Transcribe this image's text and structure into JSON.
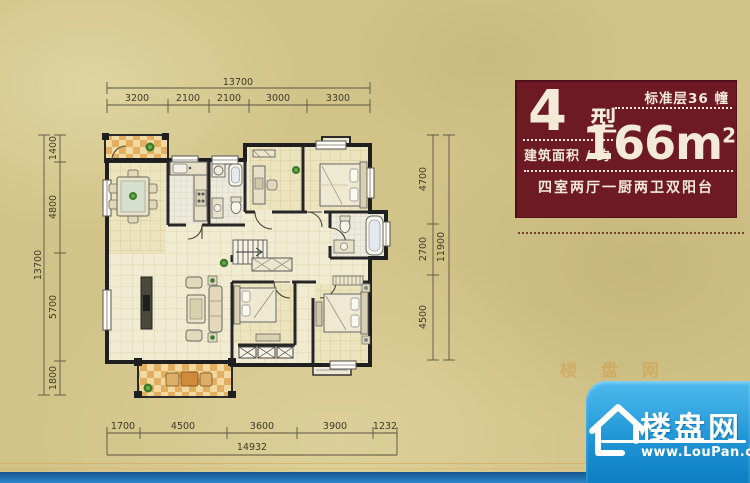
{
  "info_panel": {
    "type_number": "4",
    "type_suffix": "型",
    "floors_label": "标准层36 幢",
    "area_label": "建筑面积 / 约",
    "area_value": "166m",
    "area_exponent": "2",
    "description": "四室两厅一厨两卫双阳台",
    "bg_color": "#6d1a24"
  },
  "dimensions": {
    "top": {
      "total": "13700",
      "segments": [
        "3200",
        "2100",
        "2100",
        "3000",
        "3300"
      ]
    },
    "left": {
      "total": "13700",
      "segments": [
        "1400",
        "4800",
        "5700",
        "1800"
      ]
    },
    "right": {
      "total": "11900",
      "segments": [
        "4700",
        "2700",
        "4500"
      ]
    },
    "bottom": {
      "total": "14932",
      "segments": [
        "1700",
        "4500",
        "3600",
        "3900",
        "1232"
      ]
    }
  },
  "watermark": {
    "faint_text": "楼盘网",
    "brand": "楼盘网",
    "url": "www.LouPan.com",
    "badge_blue_top": "#4fbbee",
    "badge_blue_bottom": "#0d7ec3",
    "bar_blue": "#2478ba"
  },
  "plan_colors": {
    "wall": "#1f1f1f",
    "balcony_tile_light": "#f3d99f",
    "balcony_tile_dark": "#e2ae61",
    "floor": "#f1ebd2",
    "room": "#ece4bf"
  }
}
